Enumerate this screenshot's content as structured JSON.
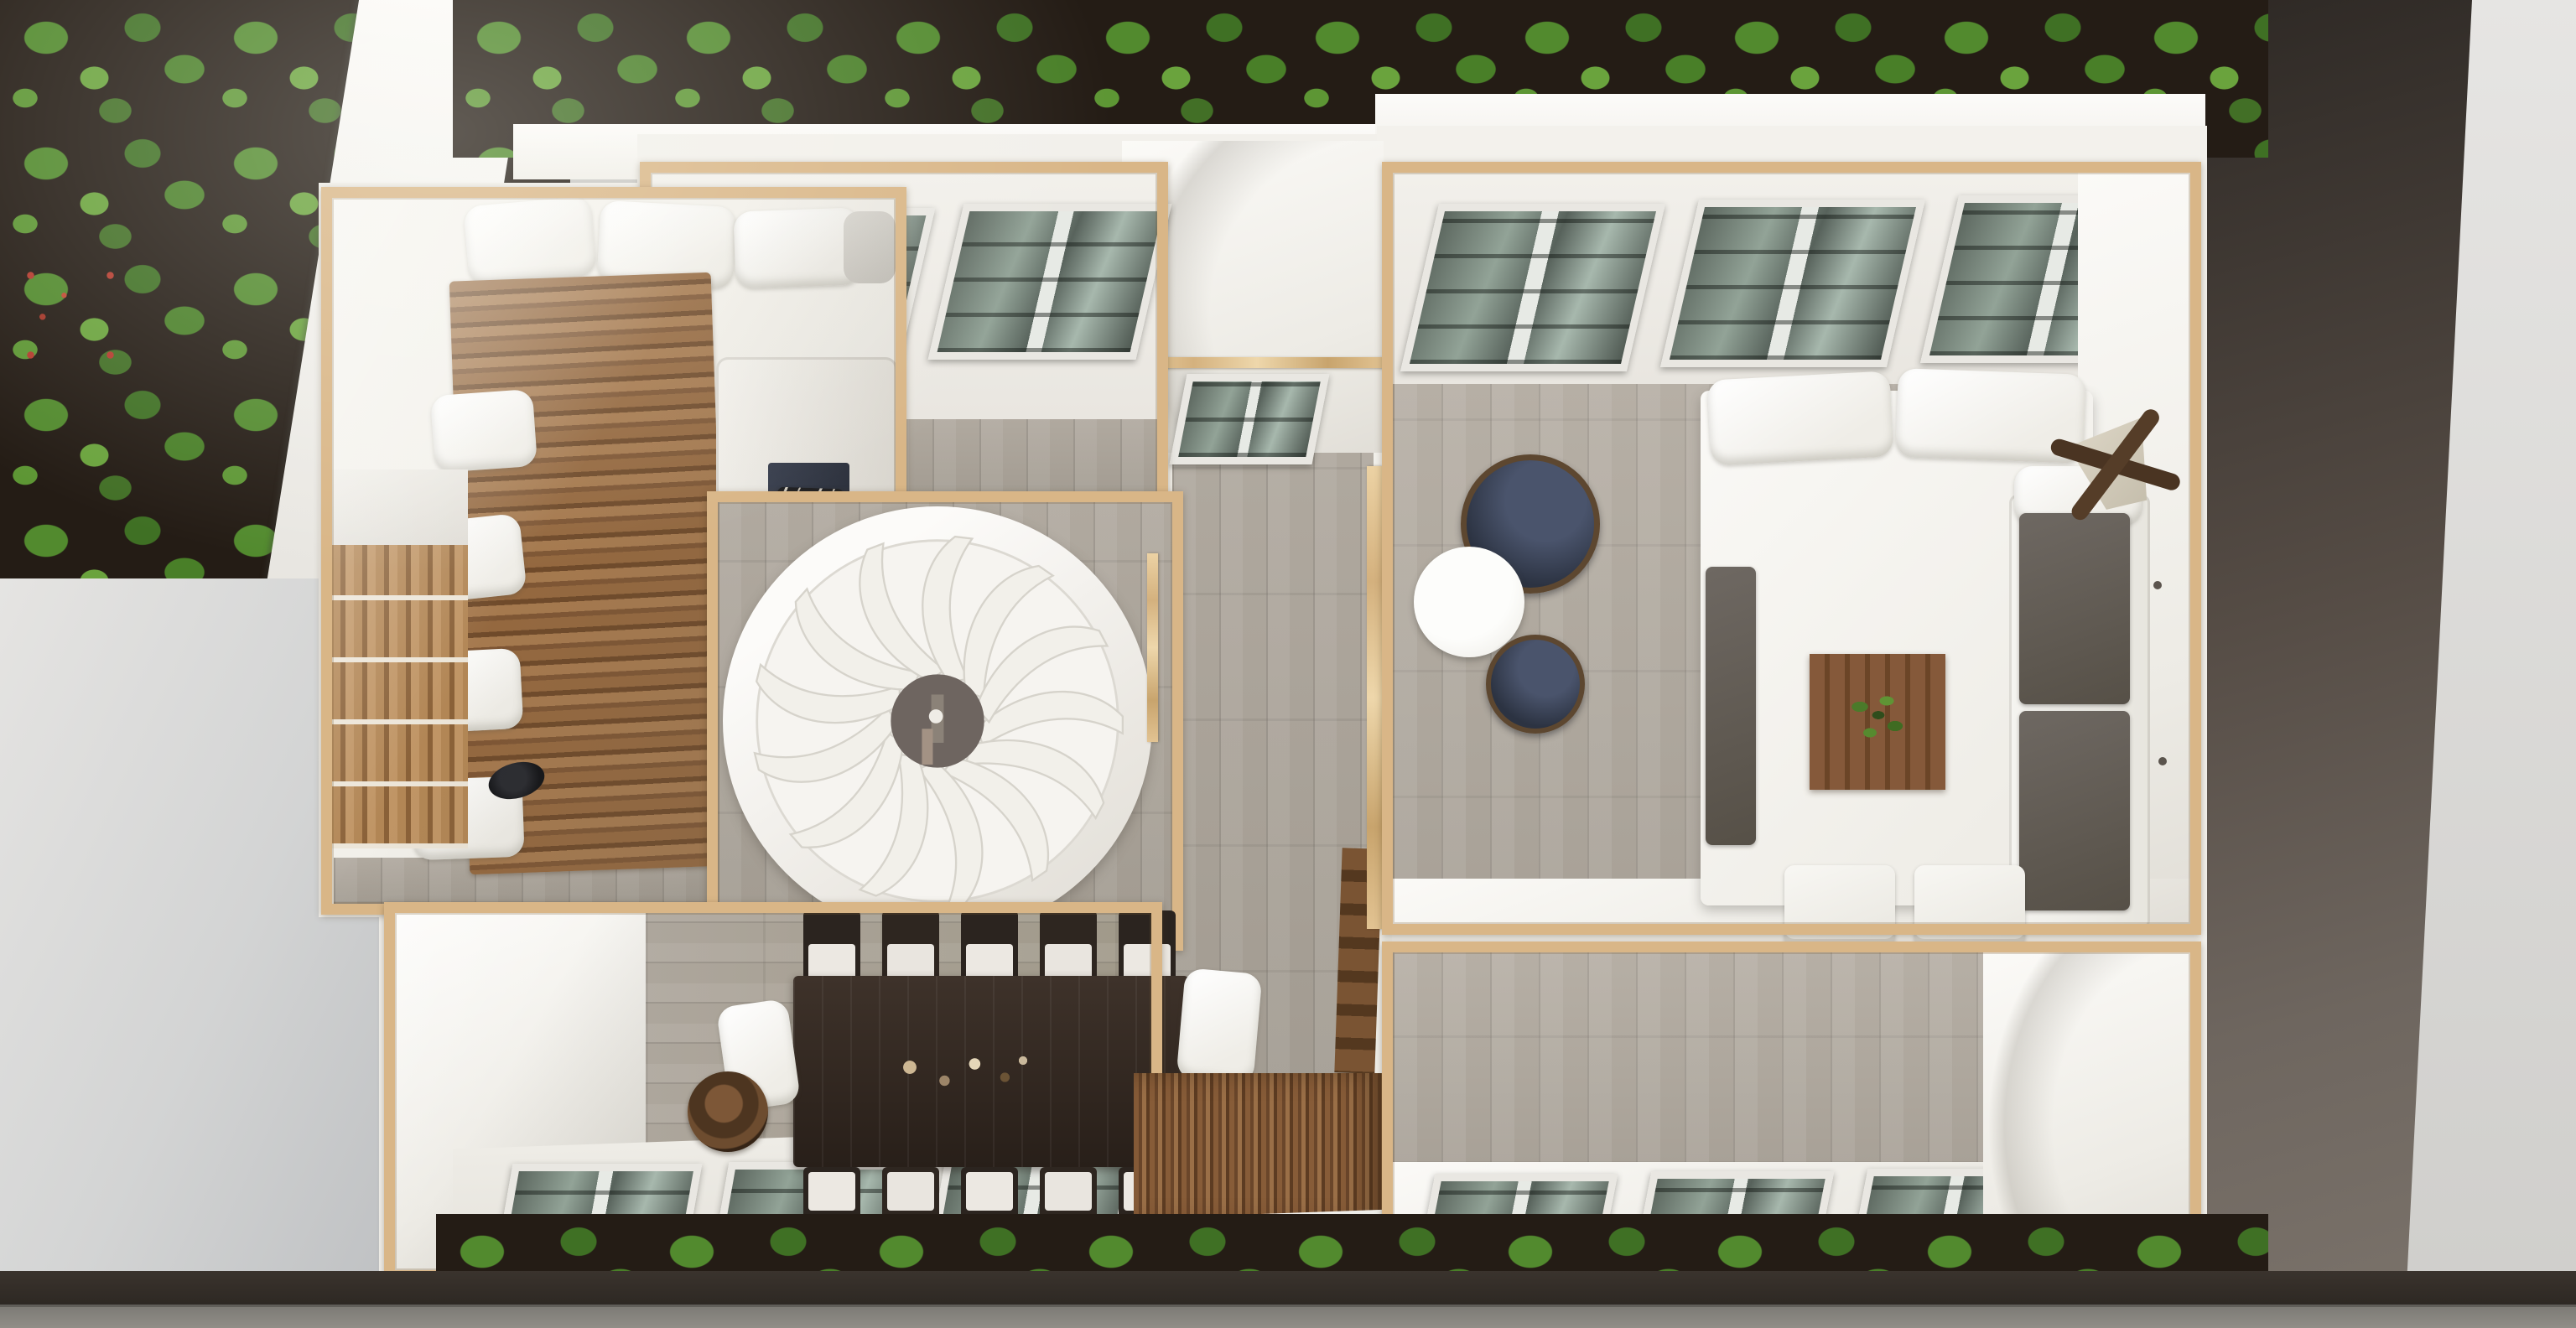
{
  "scene": {
    "kind": "top-down-aerial-view-of-modern-house-interior",
    "palette": {
      "wood_trim": "#d9b687",
      "wall_white": "#f3f1ec",
      "floor_gray": "#aba49a",
      "skylight_glass": "#6f7d76",
      "hedge_green": "#4f8a2e",
      "soil_dark": "#241c15",
      "deck_brown": "#875c38",
      "dining_table_dark": "#332920",
      "navy_seat": "#2c3342",
      "east_wall_dark": "#554c45",
      "pale_wall": "#d5d6d6",
      "pavement": "#8e8c87"
    },
    "exterior": {
      "areas": [
        "hedge-north",
        "garden-northwest",
        "red-flowers",
        "white-path",
        "pale-wall-southwest",
        "hedge-south",
        "dark-wall-east",
        "pavement-south",
        "hedge-patch-northwest"
      ]
    },
    "rooms": [
      {
        "name": "skylight-room-northwest",
        "skylights": 2,
        "floor": "gray-planks"
      },
      {
        "name": "bedroom-west",
        "furniture": [
          "pillows-white",
          "pillow-gray",
          "wood-slat-bed",
          "cushion-column-white",
          "wardrobe-slatted",
          "white-sofa",
          "navy-runner",
          "zebra-cushions",
          "black-hat-object"
        ]
      },
      {
        "name": "spiral-stair-room",
        "stair_blades": 13,
        "center": "dark-hub",
        "rail": "wood"
      },
      {
        "name": "vestibule-north",
        "skylights": 1
      },
      {
        "name": "hallway-center",
        "features": [
          "wood-divider",
          "hidden-staircase"
        ]
      },
      {
        "name": "great-room-east",
        "skylights": 3,
        "furniture": [
          "navy-tub-chair",
          "white-round-table",
          "navy-stool",
          "large-white-table",
          "white-pillows-pair",
          "wood-tray-with-plant",
          "gray-bench",
          "white-sofa-gray-cushions",
          "butterfly-chair",
          "white-chair",
          "white-chair"
        ],
        "wall_dots": 3
      },
      {
        "name": "dining-room-southwest",
        "skylights": 3,
        "dining_chairs": 10,
        "table": "long-dark-wood",
        "extras": [
          "white-pillow-left",
          "white-pillow-right",
          "round-wood-tray",
          "tableware-cluster"
        ]
      },
      {
        "name": "deck-south",
        "material": "striped-wood"
      },
      {
        "name": "room-southeast",
        "skylights": 3,
        "floor": "gray-planks"
      }
    ],
    "totals": {
      "skylights": 12,
      "rooms": 9
    }
  }
}
